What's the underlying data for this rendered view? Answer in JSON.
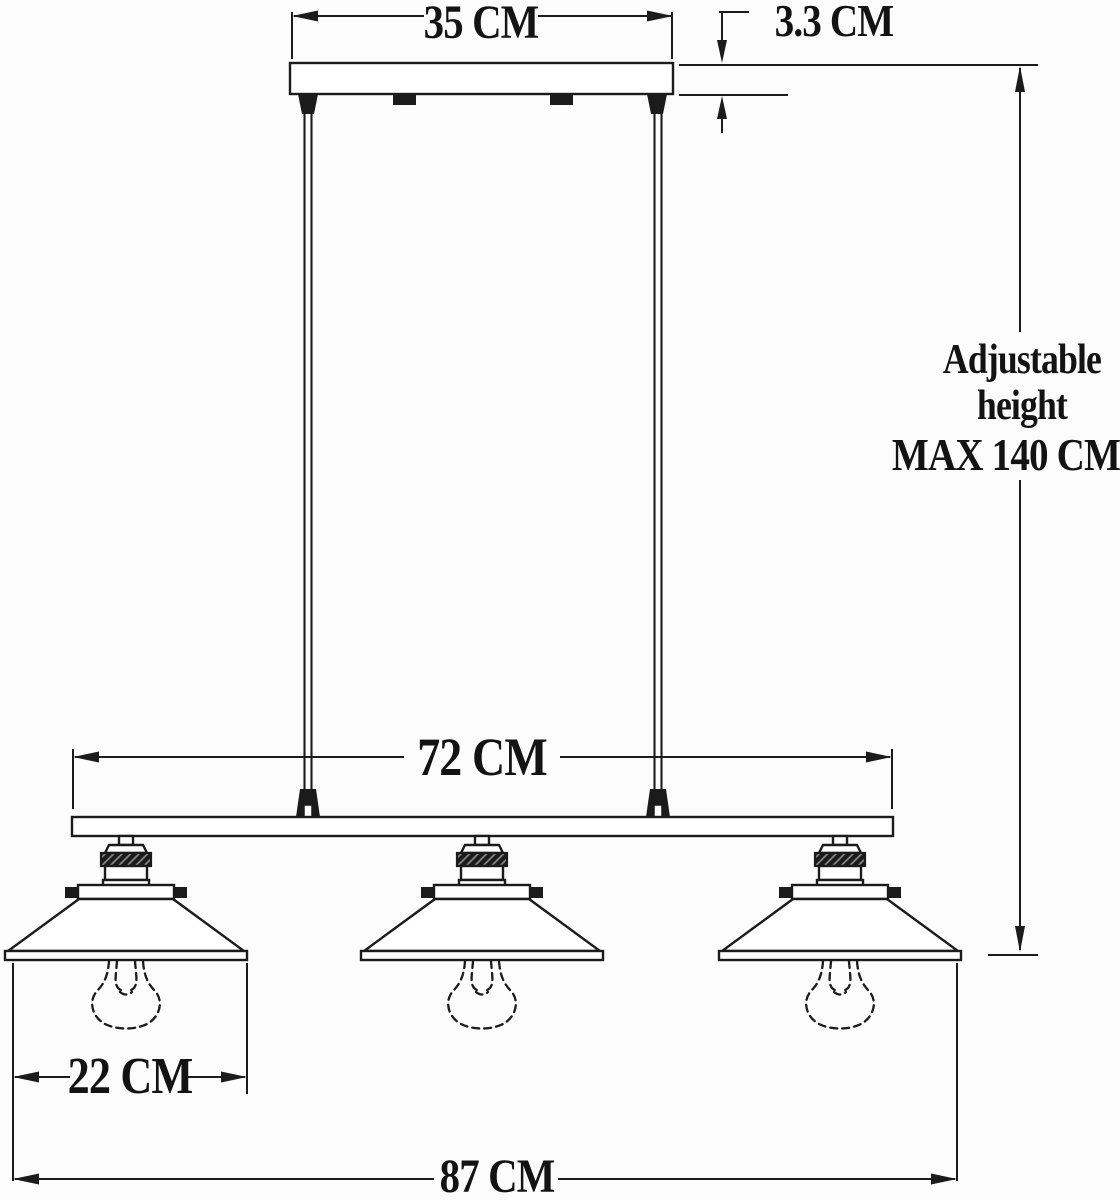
{
  "diagram": {
    "labels": {
      "canopy_width": "35 CM",
      "canopy_thickness": "3.3 CM",
      "adjustable_height": "Adjustable height",
      "max_height": "MAX 140 CM",
      "inner_span": "72 CM",
      "shade_width": "22 CM",
      "overall_width": "87 CM"
    },
    "colors": {
      "background": "#fcfcfc",
      "line": "#1b1b1b",
      "text": "#131313"
    }
  }
}
